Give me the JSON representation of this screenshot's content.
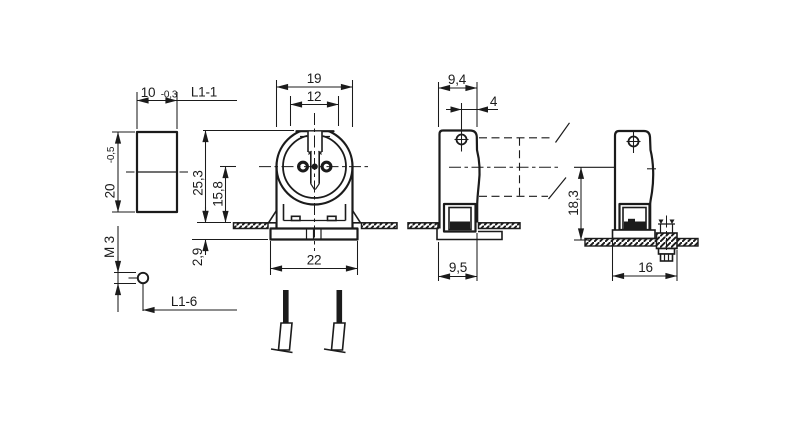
{
  "drawing": {
    "type": "technical-drawing",
    "subject": "fluorescent lampholder",
    "colors": {
      "line": "#1b1b1b",
      "background": "#ffffff"
    },
    "views": {
      "end_view": {
        "width": "10",
        "width_tolerance": "-0,3",
        "length_ref_top": "L1-1",
        "height": "20",
        "height_tolerance": "-0,5",
        "thread_size": "M 3",
        "length_ref_bottom": "L1-6"
      },
      "front_view": {
        "body_width": "19",
        "slot_width": "12",
        "overall_height": "25,3",
        "axis_height": "15,8",
        "snap_depth": "2,9",
        "base_width": "22"
      },
      "side_view": {
        "body_depth": "9,4",
        "hole_offset": "4",
        "base_depth": "9,5"
      },
      "mounted_view": {
        "axis_height": "18,3",
        "fixing_distance": "16"
      }
    }
  }
}
